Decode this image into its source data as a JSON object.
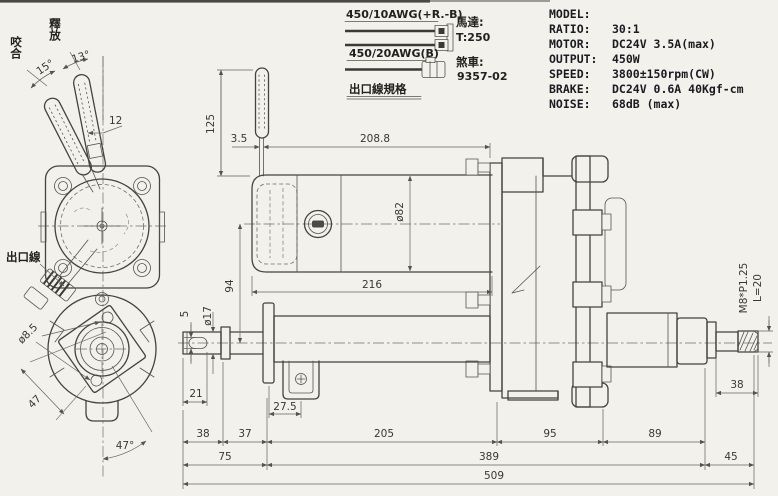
{
  "specs": {
    "rows": [
      {
        "label": "MODEL:",
        "value": ""
      },
      {
        "label": "RATIO:",
        "value": "30:1"
      },
      {
        "label": "MOTOR:",
        "value": "DC24V 3.5A(max)"
      },
      {
        "label": "OUTPUT:",
        "value": "450W"
      },
      {
        "label": "SPEED:",
        "value": "3800±150rpm(CW)"
      },
      {
        "label": "BRAKE:",
        "value": "DC24V 0.6A 40Kgf-cm"
      },
      {
        "label": "NOISE:",
        "value": "68dB (max)"
      }
    ]
  },
  "wiring": {
    "label_top": "450/10AWG(+R.-B)",
    "label_bottom": "450/20AWG(B)",
    "motor_label": "馬達:",
    "motor_value": "T:250",
    "brake_label": "煞車:",
    "brake_value": "9357-02",
    "caption": "出口線規格"
  },
  "front_view": {
    "label_engage": "咬合",
    "label_release": "釋放",
    "angle_left": "15°",
    "angle_right": "13°",
    "dim_lever_offset": "12",
    "label_outlet_wire": "出口線",
    "dim_hole_dia": "ø8.5",
    "dim_bolt_spacing": "47",
    "angle_bottom": "47°"
  },
  "side_view": {
    "dim_lever_height": "125",
    "dim_lever_width": "3.5",
    "dim_motor_top": "208.8",
    "dim_motor_dia": "ø82",
    "dim_motor_len": "216",
    "dim_center_offset": "94",
    "dim_key_width": "5",
    "dim_shaft_dia": "ø17",
    "dim_key_len": "21",
    "dim_bracket": "27.5",
    "dim_a": "38",
    "dim_b": "37",
    "dim_c": "205",
    "dim_d": "95",
    "dim_e": "89",
    "dim_f": "75",
    "dim_g": "389",
    "dim_h": "45",
    "dim_total": "509",
    "dim_shaft_end": "38",
    "thread_spec": "M8*P1.25",
    "thread_len": "L=20"
  }
}
